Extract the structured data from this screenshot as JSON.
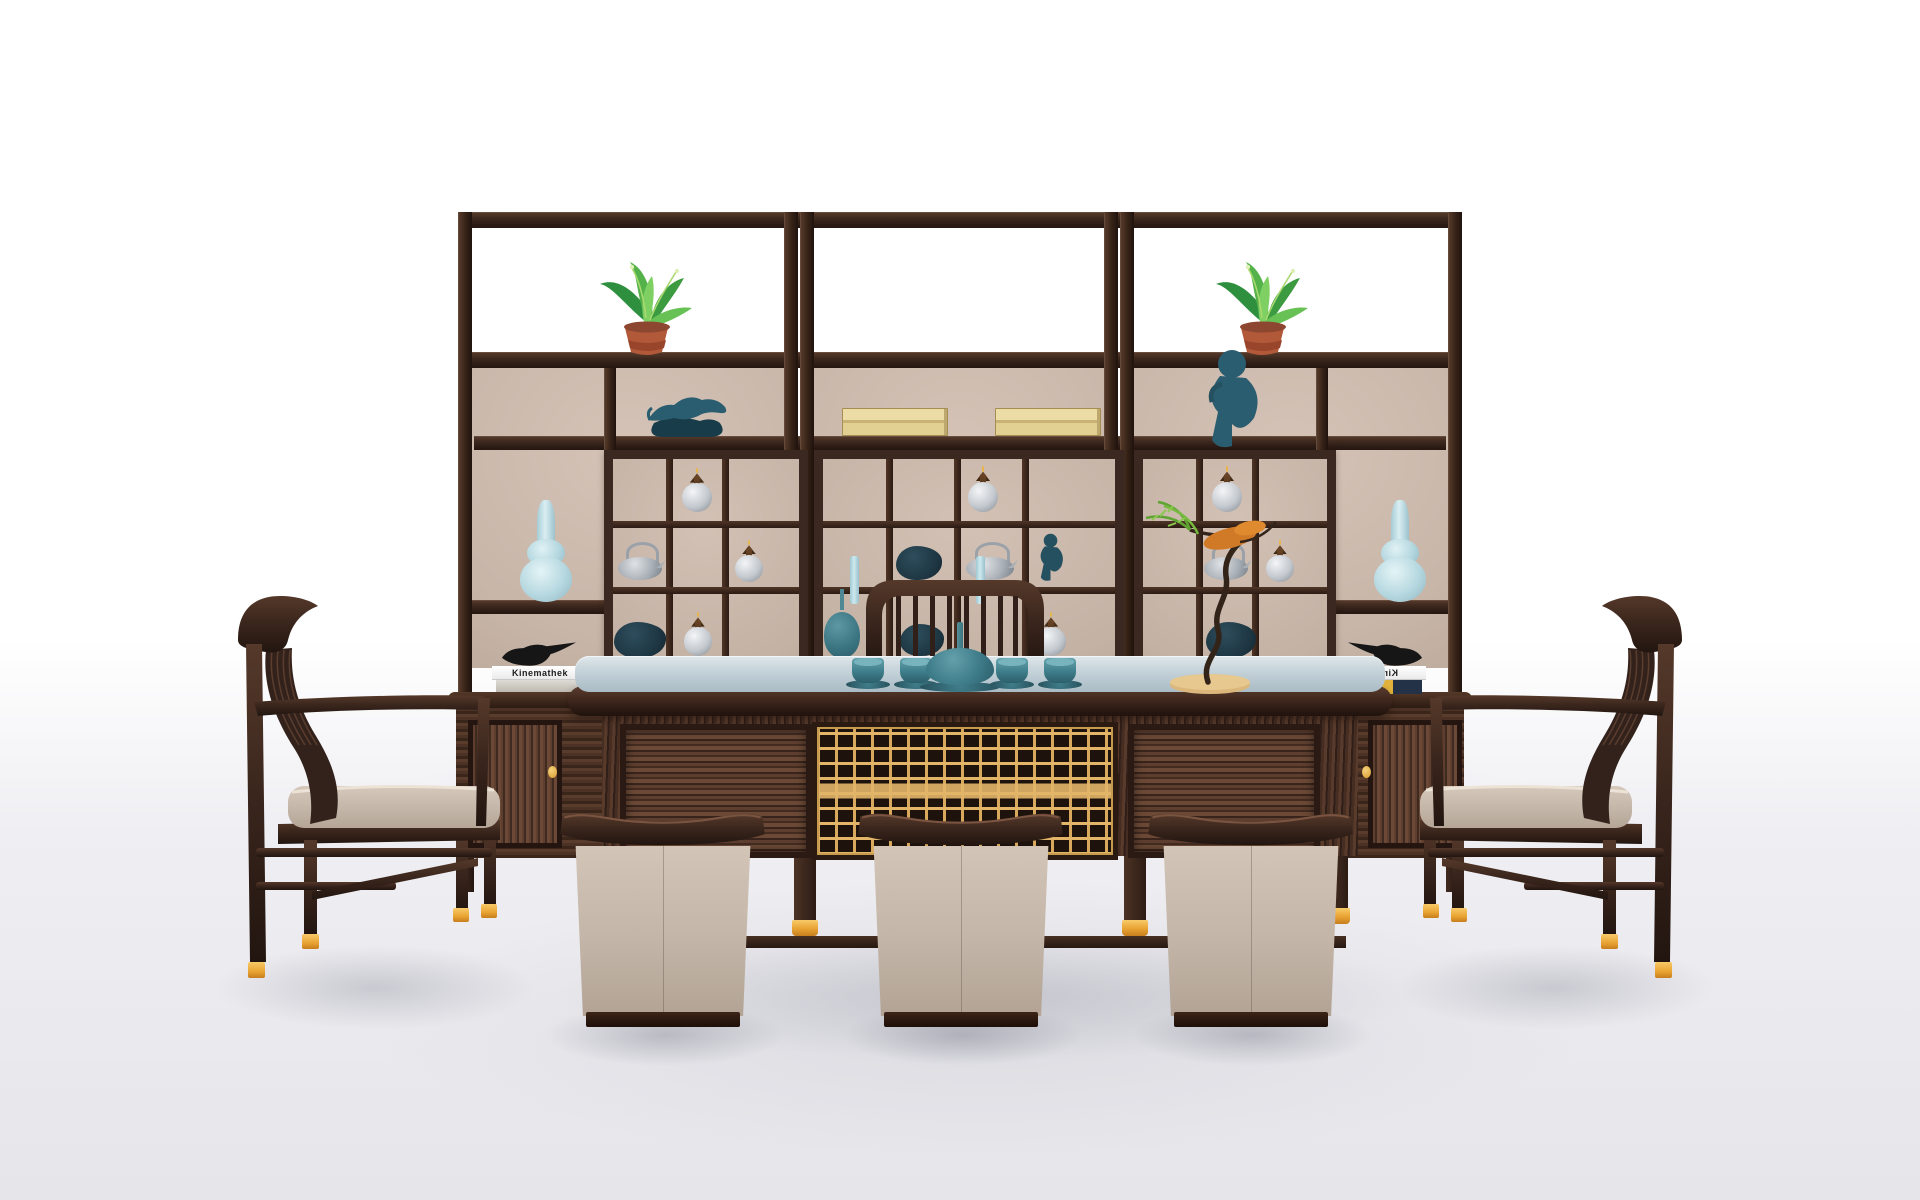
{
  "scene": {
    "description": "3D product render of a Chinese-style dark rosewood tea room set: a three-bay display shelving wall filled with curios, a long tea table with a teal tea service and gold fretwork front, two slatted armchairs and three leather drum stools on a pale studio floor",
    "book_spine_title": "Kinemathek"
  },
  "palette": {
    "wood_dark": "#32211a",
    "wood_mid": "#4c3325",
    "wood_red": "#5d3e2f",
    "back_beige": "#c7b5a8",
    "tabletop_light": "#d9e3e7",
    "tabletop_deep": "#a9bbc5",
    "teal_glaze": "#3e7d8a",
    "celadon": "#bcdde5",
    "silver": "#c4c9cf",
    "fret_gold": "#e2b569",
    "gold_foot": "#e8a332",
    "leather": "#c3b5a7",
    "terracotta": "#b2593a",
    "leaf_green": "#3f9e3e",
    "orange_leaf": "#d07a28",
    "book_gold": "#e2cf92",
    "figurine_teal": "#2b5d70",
    "floor_grey": "#e5e5ea"
  },
  "counts": {
    "shelf_units": 3,
    "armchairs": 2,
    "stools": 3,
    "tea_cups": 4,
    "silver_jars": 7,
    "silver_teapots": 3,
    "potted_plants": 2,
    "celadon_vases": 2,
    "bird_figurines": 2
  }
}
